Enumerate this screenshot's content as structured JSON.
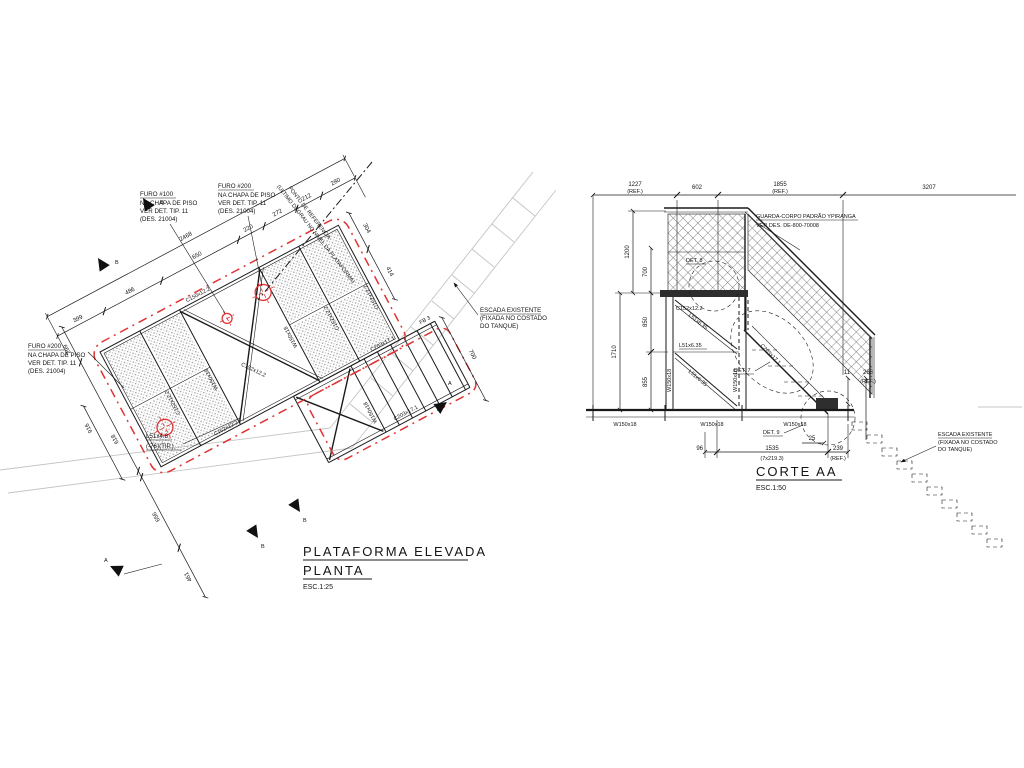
{
  "p": {
    "title1": "PLATAFORMA ELEVADA",
    "title2": "PLANTA",
    "scale": "ESC.1:25",
    "furo100": {
      "a": "FURO #100",
      "b": "NA CHAPA DE PISO",
      "c": "VER DET. TIP. 11",
      "d": "(DES. 21004)"
    },
    "furo200": {
      "a": "FURO #200",
      "b": "NA CHAPA DE PISO",
      "c": "VER DET. TIP. 11",
      "d": "(DES. 21004)"
    },
    "escada": {
      "a": "ESCADA EXISTENTE",
      "b": "(FIXADA NO COSTADO",
      "c": "DO TANQUE)"
    },
    "ponto": {
      "a": "PONTO DE REFERENCIA",
      "b": "(ULTIMO DEGRAU NO NIVEL DA PLATAFORMA)"
    },
    "l51": {
      "a": "L51x4.8",
      "b": "(-76)(TIP.)"
    },
    "dim": {
      "total": "2468",
      "d399": "399",
      "d486": "486",
      "d650": "650",
      "d220": "220",
      "d272": "272",
      "d212": "212",
      "d280": "280",
      "d304": "304",
      "d414": "414",
      "d299": "299",
      "d916": "916",
      "d618": "618",
      "d656": "656",
      "d461": "461",
      "d700": "700"
    },
    "m": {
      "c150": "C150x12.2",
      "c152": "C152x12.2",
      "w150": "W150x18",
      "c203": "C203x17.1",
      "fb3": "FB 3"
    },
    "mk": {
      "a": "A",
      "b": "B"
    }
  },
  "s": {
    "title": "CORTE AA",
    "scale": "ESC.1:50",
    "guarda": {
      "a": "GUARDA-CORPO PADRÃO YPIRANGA",
      "b": "VER DES. DE-800-70008"
    },
    "escada": {
      "a": "ESCADA EXISTENTE",
      "b": "(FIXADA NO COSTADO",
      "c": "DO TANQUE)"
    },
    "dim": {
      "d1227": "1227",
      "ref": "(REF.)",
      "d602": "602",
      "d1855": "1855",
      "d3207": "3207",
      "d1200": "1200",
      "d700": "700",
      "d1710": "1710",
      "d850": "850",
      "d855": "855",
      "d96": "96",
      "d1535": "1535",
      "d1535b": "(7x219.3)",
      "d239": "239",
      "d25": "25",
      "d11": "11",
      "d268": "268"
    },
    "m": {
      "w150": "W150x18",
      "c152": "C152x12.2",
      "l51": "L51x6.35",
      "c203": "C203x17.1"
    },
    "det": {
      "d7": "DET. 7",
      "d8": "DET. 8",
      "d9": "DET. 9"
    }
  }
}
